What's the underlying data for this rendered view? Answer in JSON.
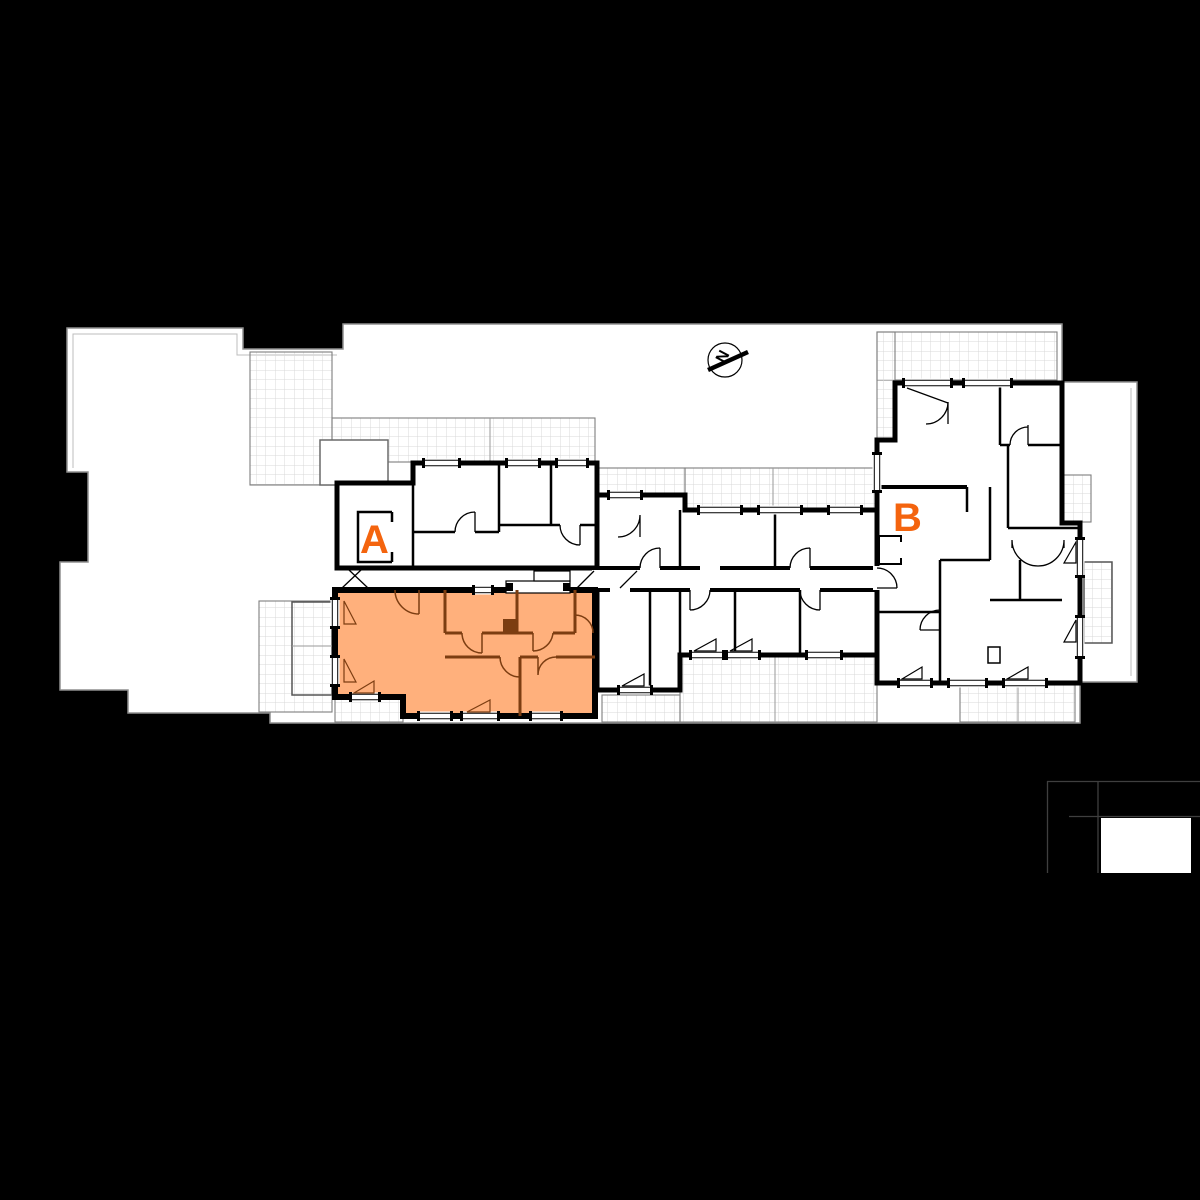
{
  "labels": {
    "unit_a": "A",
    "unit_b": "B",
    "north": "N"
  },
  "units": [
    {
      "label": "A",
      "highlighted": true
    },
    {
      "label": "B",
      "highlighted": false
    }
  ],
  "colors": {
    "background": "#000000",
    "site_fill": "#ffffff",
    "site_outline": "#8f8f8f",
    "wall": "#000000",
    "terrace_grid": "#d8d8d8",
    "terrace_border": "#7e7e7e",
    "highlight_fill": "#ffb07c",
    "highlight_wall": "#7c3d11",
    "accent_orange": "#f4640e",
    "brand_line": "#3f3f3f",
    "brand_block": "#ffffff"
  }
}
